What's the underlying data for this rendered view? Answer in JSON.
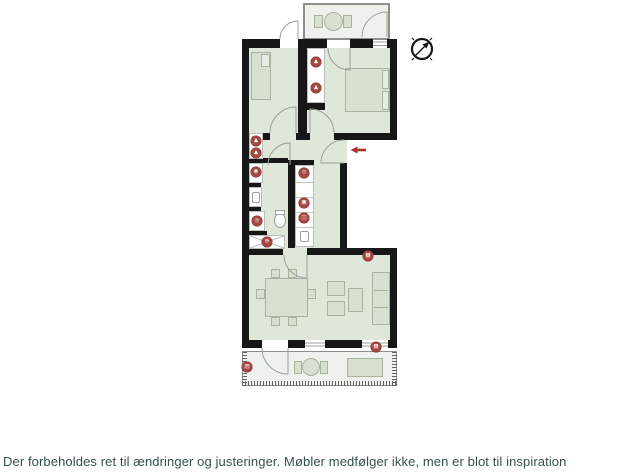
{
  "disclaimer": "Der forbeholdes ret til ændringer og justeringer. Møbler medfølger ikke, men er blot til inspiration",
  "colors": {
    "marker_red": "#a54743",
    "arrow_red": "#a8322c",
    "wall_black": "#171717",
    "room_fill": "#dee7d9",
    "balcony_fill": "#eef1ec",
    "disclaimer_text": "#35514d"
  },
  "compass": {
    "icon": "compass-icon",
    "needle_direction": "north-east"
  },
  "entrance": {
    "icon": "entrance-arrow-icon",
    "direction": "left"
  },
  "markers": [
    {
      "icon": "hanger-icon",
      "glyph": "▲"
    },
    {
      "icon": "hanger-icon",
      "glyph": "▲"
    },
    {
      "icon": "hanger-icon",
      "glyph": "▲"
    },
    {
      "icon": "hanger-icon",
      "glyph": "▲"
    },
    {
      "icon": "washing-machine-icon",
      "glyph": "◉"
    },
    {
      "icon": "dryer-icon",
      "glyph": "◎"
    },
    {
      "icon": "shower-icon",
      "glyph": "⊕"
    },
    {
      "icon": "stove-icon",
      "glyph": "⊙"
    },
    {
      "icon": "oven-icon",
      "glyph": "▣"
    },
    {
      "icon": "dishwasher-icon",
      "glyph": "◫"
    },
    {
      "icon": "radiator-icon",
      "glyph": "▦"
    },
    {
      "icon": "radiator-icon",
      "glyph": "▦"
    },
    {
      "icon": "outdoor-heater-icon",
      "glyph": "▤"
    }
  ]
}
